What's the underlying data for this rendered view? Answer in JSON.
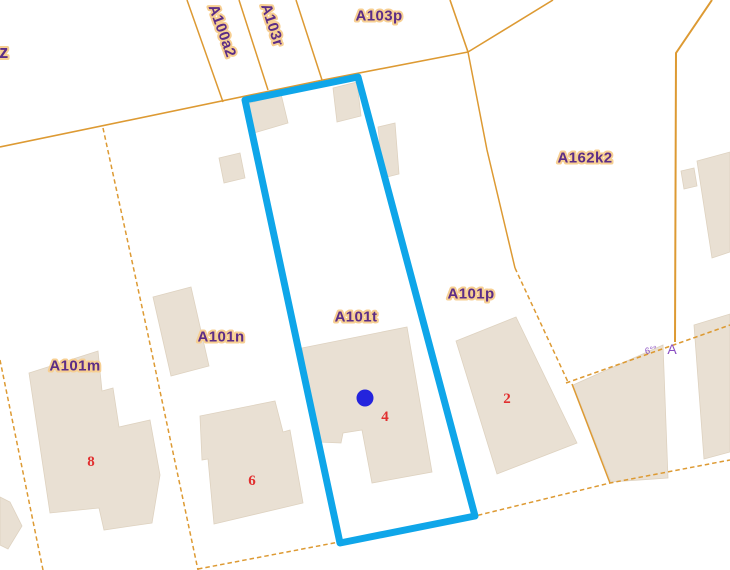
{
  "map": {
    "width": 730,
    "height": 570,
    "background": "#ffffff",
    "colors": {
      "boundary": "#dd9a33",
      "building_fill": "#e9e0d3",
      "building_edge": "#ded2c0",
      "selection": "#0fa6e9",
      "marker": "#2424dd",
      "label_text": "#5c2d86",
      "label_halo": "#f7cf92",
      "house_number": "#e12f2f",
      "annotation": "#8a4ec2"
    },
    "selected_parcel": {
      "id": "A101t",
      "outline": [
        [
          245,
          100
        ],
        [
          358,
          77
        ],
        [
          475,
          516
        ],
        [
          340,
          543
        ]
      ],
      "marker": {
        "x": 365,
        "y": 398,
        "r": 8.5
      }
    },
    "boundaries": [
      {
        "points": [
          [
            0,
            147
          ],
          [
            323,
            80
          ],
          [
            468,
            52
          ]
        ],
        "dashed": false,
        "width": 1.6
      },
      {
        "points": [
          [
            187,
            0
          ],
          [
            223,
            102
          ]
        ],
        "dashed": false,
        "width": 1.5
      },
      {
        "points": [
          [
            239,
            0
          ],
          [
            268,
            90
          ]
        ],
        "dashed": false,
        "width": 1.5
      },
      {
        "points": [
          [
            296,
            0
          ],
          [
            322,
            80
          ]
        ],
        "dashed": false,
        "width": 1.5
      },
      {
        "points": [
          [
            450,
            0
          ],
          [
            468,
            52
          ]
        ],
        "dashed": false,
        "width": 1.6
      },
      {
        "points": [
          [
            468,
            52
          ],
          [
            553,
            0
          ]
        ],
        "dashed": false,
        "width": 1.6
      },
      {
        "points": [
          [
            468,
            52
          ],
          [
            487,
            150
          ],
          [
            515,
            268
          ]
        ],
        "dashed": false,
        "width": 1.5
      },
      {
        "points": [
          [
            515,
            268
          ],
          [
            568,
            382
          ]
        ],
        "dashed": true,
        "width": 1.5
      },
      {
        "points": [
          [
            712,
            0
          ],
          [
            676,
            53
          ],
          [
            675,
            342
          ]
        ],
        "dashed": false,
        "width": 2
      },
      {
        "points": [
          [
            566,
            383
          ],
          [
            730,
            325
          ]
        ],
        "dashed": true,
        "width": 1.5
      },
      {
        "points": [
          [
            572,
            384
          ],
          [
            610,
            483
          ]
        ],
        "dashed": false,
        "width": 1.5
      },
      {
        "points": [
          [
            198,
            569
          ],
          [
            475,
            516
          ],
          [
            610,
            483
          ],
          [
            730,
            460
          ]
        ],
        "dashed": true,
        "width": 1.5
      },
      {
        "points": [
          [
            103,
            128
          ],
          [
            147,
            330
          ],
          [
            198,
            570
          ]
        ],
        "dashed": true,
        "width": 1.5
      },
      {
        "points": [
          [
            0,
            360
          ],
          [
            43,
            570
          ]
        ],
        "dashed": true,
        "width": 1.5
      }
    ],
    "buildings": [
      {
        "points": [
          [
            247,
            104
          ],
          [
            281,
            94
          ],
          [
            288,
            123
          ],
          [
            254,
            133
          ]
        ]
      },
      {
        "points": [
          [
            333,
            88
          ],
          [
            357,
            82
          ],
          [
            361,
            116
          ],
          [
            337,
            122
          ]
        ]
      },
      {
        "points": [
          [
            378,
            127
          ],
          [
            395,
            123
          ],
          [
            399,
            174
          ],
          [
            383,
            178
          ]
        ]
      },
      {
        "points": [
          [
            219,
            158
          ],
          [
            240,
            153
          ],
          [
            245,
            178
          ],
          [
            224,
            183
          ]
        ]
      },
      {
        "points": [
          [
            153,
            297
          ],
          [
            191,
            287
          ],
          [
            209,
            366
          ],
          [
            171,
            376
          ]
        ]
      },
      {
        "points": [
          [
            200,
            416
          ],
          [
            275,
            401
          ],
          [
            283,
            432
          ],
          [
            290,
            430
          ],
          [
            303,
            503
          ],
          [
            214,
            524
          ],
          [
            208,
            459
          ],
          [
            202,
            460
          ]
        ]
      },
      {
        "points": [
          [
            302,
            348
          ],
          [
            407,
            327
          ],
          [
            432,
            472
          ],
          [
            372,
            483
          ],
          [
            362,
            430
          ],
          [
            343,
            433
          ],
          [
            341,
            443
          ],
          [
            318,
            442
          ]
        ]
      },
      {
        "points": [
          [
            29,
            373
          ],
          [
            98,
            351
          ],
          [
            102,
            391
          ],
          [
            113,
            388
          ],
          [
            119,
            427
          ],
          [
            150,
            420
          ],
          [
            160,
            475
          ],
          [
            152,
            523
          ],
          [
            104,
            530
          ],
          [
            99,
            508
          ],
          [
            50,
            513
          ]
        ]
      },
      {
        "points": [
          [
            456,
            341
          ],
          [
            516,
            317
          ],
          [
            577,
            443
          ],
          [
            497,
            474
          ]
        ]
      },
      {
        "points": [
          [
            573,
            385
          ],
          [
            663,
            345
          ],
          [
            668,
            478
          ],
          [
            611,
            482
          ]
        ]
      },
      {
        "points": [
          [
            694,
            325
          ],
          [
            730,
            314
          ],
          [
            730,
            452
          ],
          [
            704,
            459
          ]
        ]
      },
      {
        "points": [
          [
            697,
            161
          ],
          [
            730,
            152
          ],
          [
            730,
            252
          ],
          [
            712,
            258
          ]
        ]
      },
      {
        "points": [
          [
            681,
            171
          ],
          [
            694,
            168
          ],
          [
            697,
            186
          ],
          [
            684,
            189
          ]
        ]
      },
      {
        "points": [
          [
            0,
            497
          ],
          [
            10,
            502
          ],
          [
            22,
            526
          ],
          [
            8,
            549
          ],
          [
            0,
            545
          ]
        ]
      }
    ],
    "parcel_labels": [
      {
        "text": "z",
        "x": 4,
        "y": 52,
        "rotate": 0,
        "size": 18
      },
      {
        "text": "A100a2",
        "x": 222,
        "y": 31,
        "rotate": 70,
        "size": 15
      },
      {
        "text": "A103r",
        "x": 272,
        "y": 25,
        "rotate": 72,
        "size": 15
      },
      {
        "text": "A103p",
        "x": 379,
        "y": 16,
        "rotate": 0,
        "size": 15
      },
      {
        "text": "A162k2",
        "x": 585,
        "y": 158,
        "rotate": 0,
        "size": 15
      },
      {
        "text": "A101p",
        "x": 471,
        "y": 294,
        "rotate": 0,
        "size": 15
      },
      {
        "text": "A101t",
        "x": 356,
        "y": 317,
        "rotate": 0,
        "size": 15
      },
      {
        "text": "A101n",
        "x": 221,
        "y": 337,
        "rotate": 0,
        "size": 15
      },
      {
        "text": "A101m",
        "x": 75,
        "y": 366,
        "rotate": 0,
        "size": 15
      }
    ],
    "house_numbers": [
      {
        "text": "8",
        "x": 91,
        "y": 462
      },
      {
        "text": "6",
        "x": 252,
        "y": 481
      },
      {
        "text": "4",
        "x": 385,
        "y": 417
      },
      {
        "text": "2",
        "x": 507,
        "y": 399
      }
    ],
    "annotations": [
      {
        "text": "A",
        "x": 672,
        "y": 349,
        "size": 14,
        "rotate": 0
      },
      {
        "text": "6°°",
        "x": 651,
        "y": 350,
        "size": 9,
        "rotate": -12
      }
    ]
  }
}
